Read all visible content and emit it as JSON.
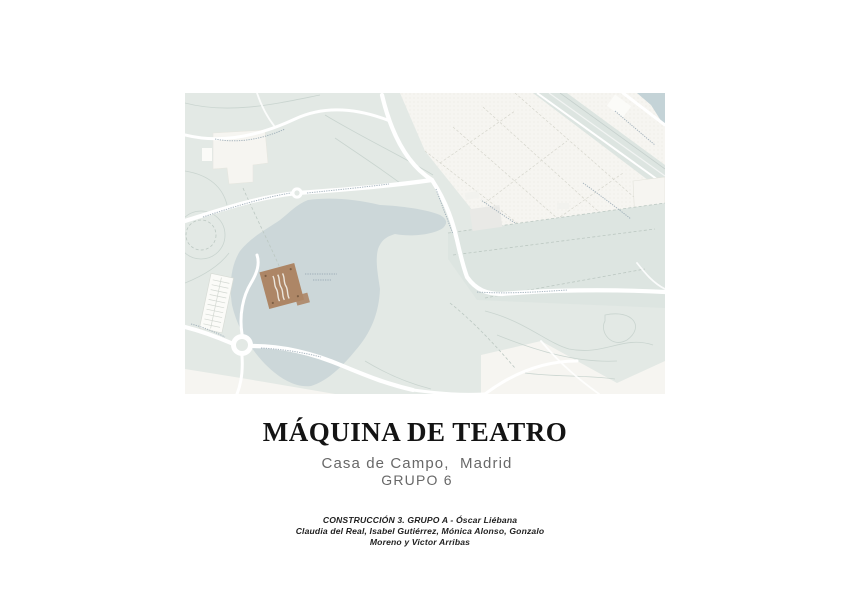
{
  "header": {
    "title": "MÁQUINA DE TEATRO",
    "subtitle": "Casa de Campo,  Madrid",
    "group": "GRUPO 6"
  },
  "credits": {
    "line1": "CONSTRUCCIÓN 3. GRUPO A - Óscar Liébana",
    "line2": "Claudia del Real, Isabel Gutiérrez, Mónica Alonso, Gonzalo",
    "line3": "Moreno y Victor Arribas"
  },
  "map": {
    "description": "site-plan-casa-de-campo-lake-with-project-marker",
    "colors": {
      "park": "#e3e9e5",
      "lake": "#ccd7d9",
      "parcel_light": "#f6f5f1",
      "parcel_shaded": "#dde5e1",
      "road": "#ffffff",
      "marker": "#ad8666",
      "river": "#c4d3d7"
    }
  }
}
